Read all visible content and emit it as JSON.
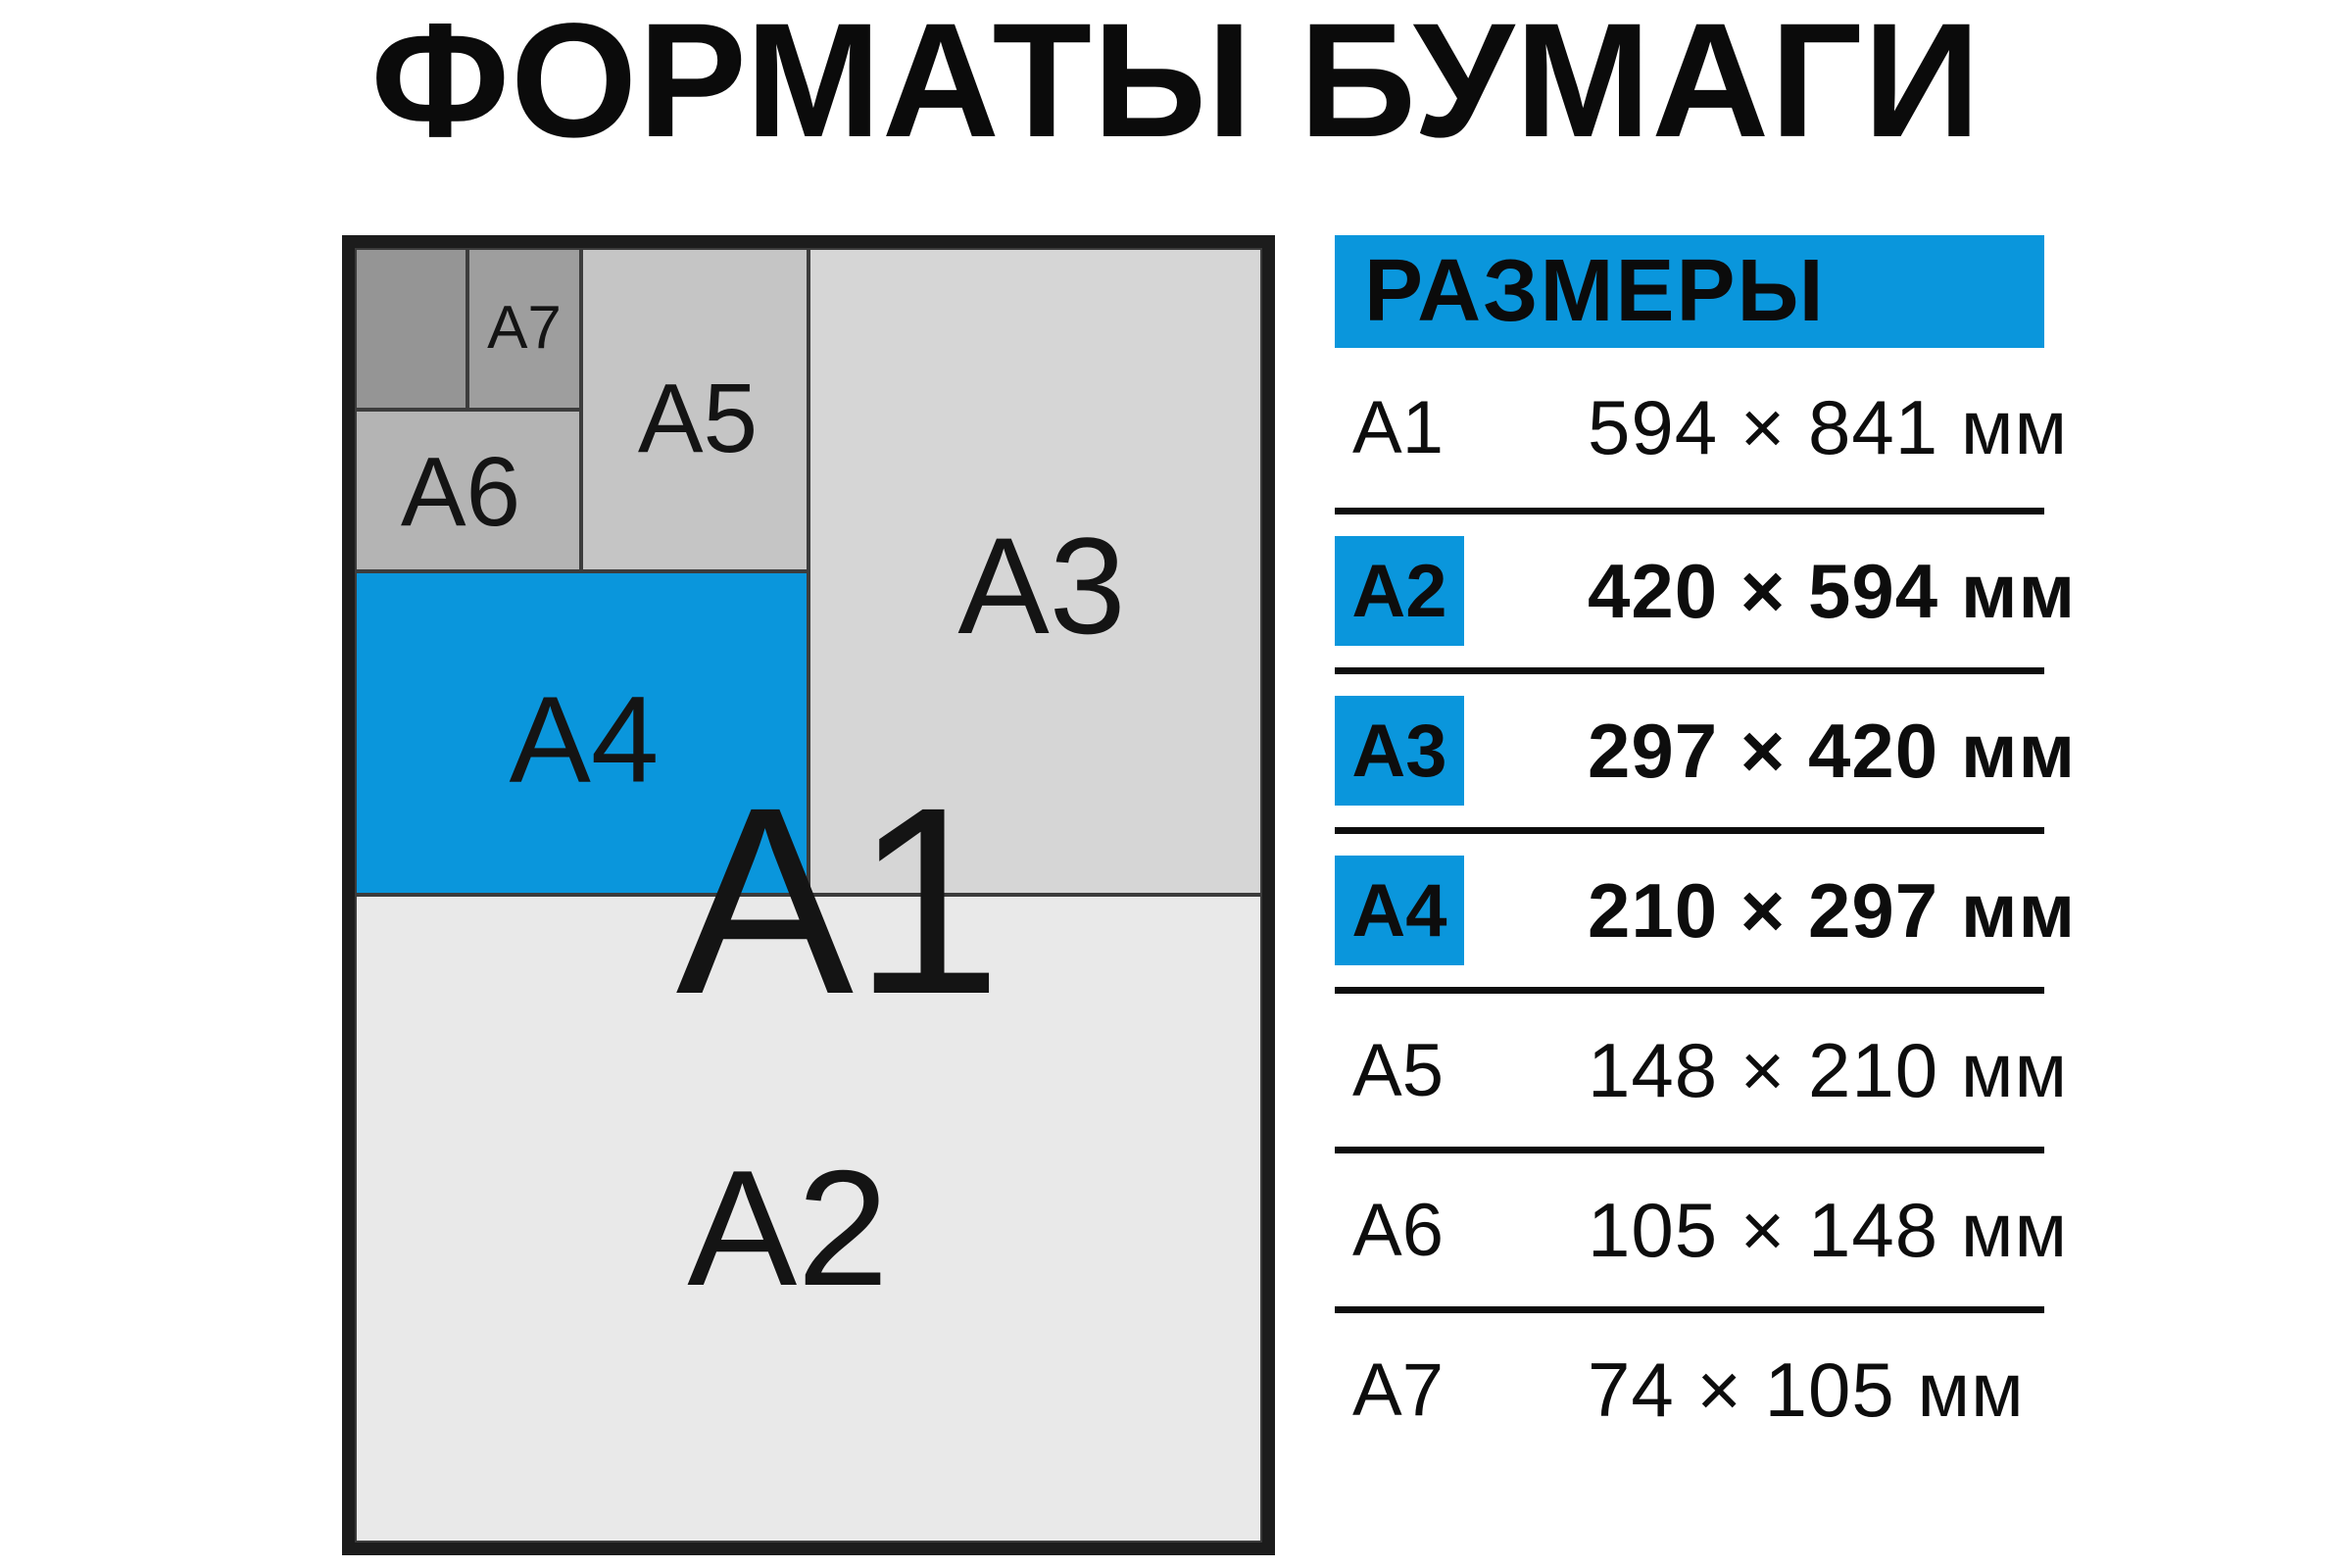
{
  "title": "ФОРМАТЫ БУМАГИ",
  "colors": {
    "accent": "#0A96DC",
    "ink": "#0D0D0D"
  },
  "diagram": {
    "labels": {
      "a1": "А1",
      "a2": "А2",
      "a3": "А3",
      "a4": "А4",
      "a5": "А5",
      "a6": "А6",
      "a7": "А7"
    }
  },
  "table": {
    "header": "РАЗМЕРЫ",
    "rows": [
      {
        "format": "А1",
        "size": "594 × 841 мм",
        "highlight": false
      },
      {
        "format": "А2",
        "size": "420 × 594 мм",
        "highlight": true
      },
      {
        "format": "А3",
        "size": "297 × 420 мм",
        "highlight": true
      },
      {
        "format": "А4",
        "size": "210 × 297 мм",
        "highlight": true
      },
      {
        "format": "А5",
        "size": "148 × 210 мм",
        "highlight": false
      },
      {
        "format": "А6",
        "size": "105 × 148 мм",
        "highlight": false
      },
      {
        "format": "А7",
        "size": "74 × 105 мм",
        "highlight": false
      }
    ]
  }
}
